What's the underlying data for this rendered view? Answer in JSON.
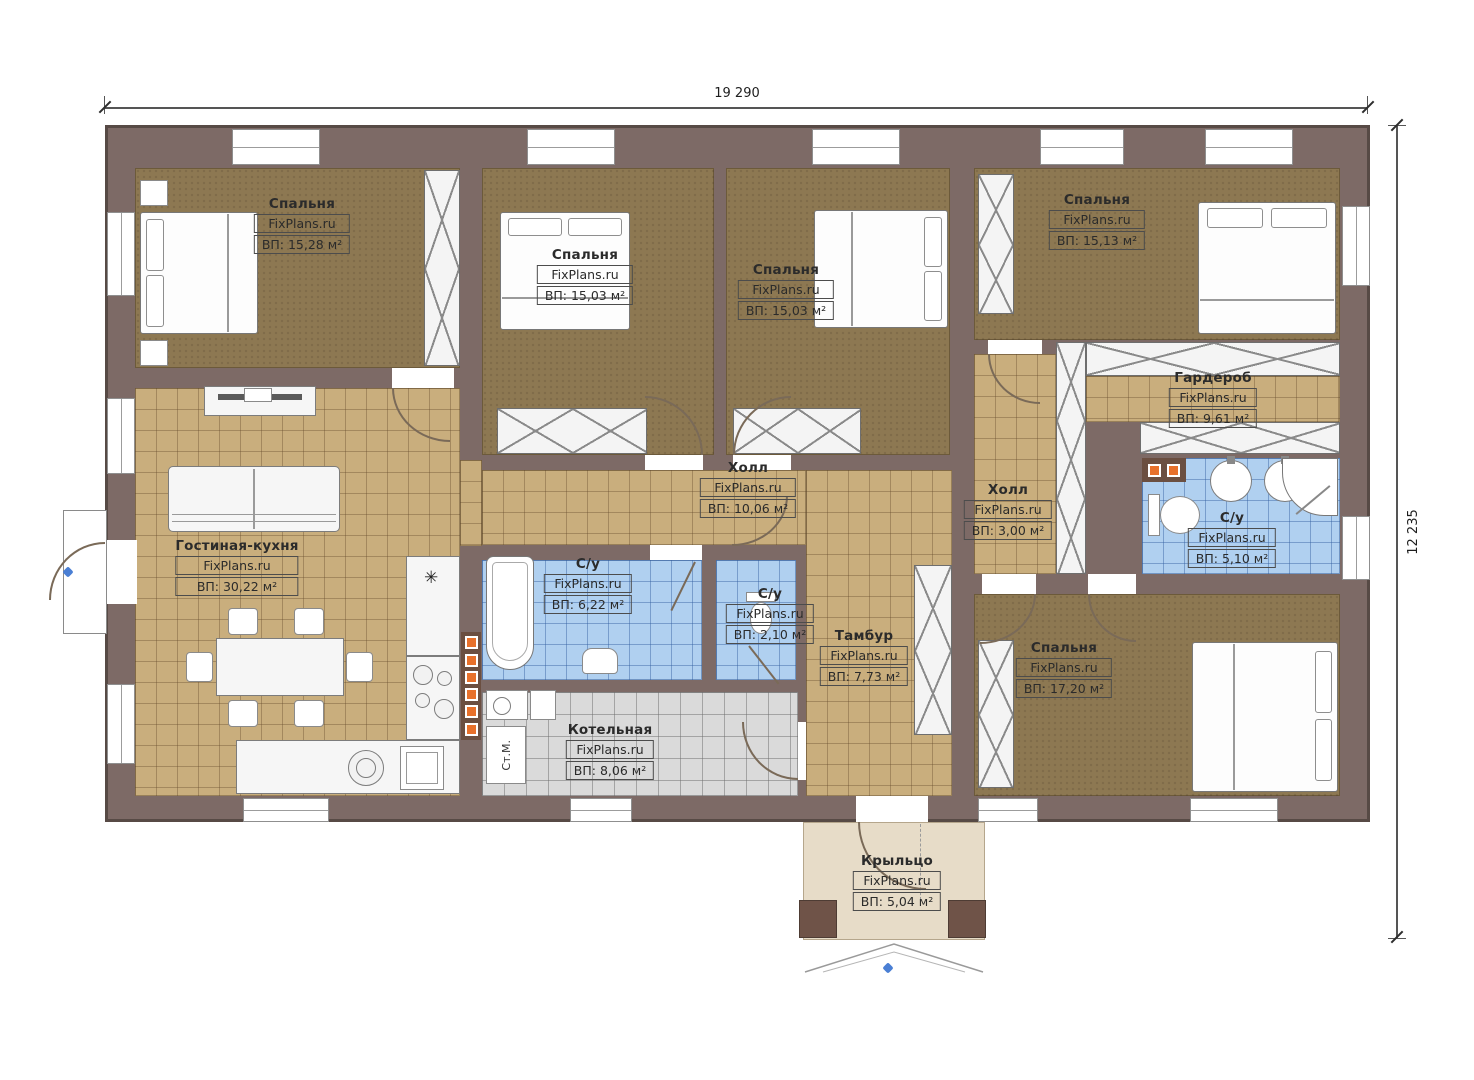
{
  "dimensions": {
    "top": "19 290",
    "right": "12 235"
  },
  "rooms": [
    {
      "id": "bedroom-1",
      "name": "Спальня",
      "brand": "FixPlans.ru",
      "area": "ВП: 15,28 м²"
    },
    {
      "id": "bedroom-2",
      "name": "Спальня",
      "brand": "FixPlans.ru",
      "area": "ВП: 15,03 м²"
    },
    {
      "id": "bedroom-3",
      "name": "Спальня",
      "brand": "FixPlans.ru",
      "area": "ВП: 15,03 м²"
    },
    {
      "id": "bedroom-4",
      "name": "Спальня",
      "brand": "FixPlans.ru",
      "area": "ВП: 15,13 м²"
    },
    {
      "id": "wardrobe-room",
      "name": "Гардероб",
      "brand": "FixPlans.ru",
      "area": "ВП: 9,61 м²"
    },
    {
      "id": "hall-main",
      "name": "Холл",
      "brand": "FixPlans.ru",
      "area": "ВП: 10,06 м²"
    },
    {
      "id": "hall-2",
      "name": "Холл",
      "brand": "FixPlans.ru",
      "area": "ВП: 3,00 м²"
    },
    {
      "id": "bathroom-1",
      "name": "С/у",
      "brand": "FixPlans.ru",
      "area": "ВП: 5,10 м²"
    },
    {
      "id": "living-kitchen",
      "name": "Гостиная-кухня",
      "brand": "FixPlans.ru",
      "area": "ВП: 30,22 м²"
    },
    {
      "id": "bathroom-2",
      "name": "С/у",
      "brand": "FixPlans.ru",
      "area": "ВП: 6,22 м²"
    },
    {
      "id": "bathroom-3",
      "name": "С/у",
      "brand": "FixPlans.ru",
      "area": "ВП: 2,10 м²"
    },
    {
      "id": "tambour",
      "name": "Тамбур",
      "brand": "FixPlans.ru",
      "area": "ВП: 7,73 м²"
    },
    {
      "id": "boiler-room",
      "name": "Котельная",
      "brand": "FixPlans.ru",
      "area": "ВП: 8,06 м²"
    },
    {
      "id": "bedroom-5",
      "name": "Спальня",
      "brand": "FixPlans.ru",
      "area": "ВП: 17,20 м²"
    },
    {
      "id": "porch",
      "name": "Крыльцо",
      "brand": "FixPlans.ru",
      "area": "ВП: 5,04 м²"
    }
  ],
  "annotations": {
    "washing_machine": "Ст.М.",
    "vent": "✳"
  },
  "colors": {
    "wall": "#7d6a66",
    "floor_bedroom": "#8d7852",
    "floor_common": "#c9ae7d",
    "floor_bath": "#b0d0f0",
    "floor_boiler": "#dadada",
    "floor_porch": "#e7dcc8",
    "accent_orange": "#e8712b"
  }
}
